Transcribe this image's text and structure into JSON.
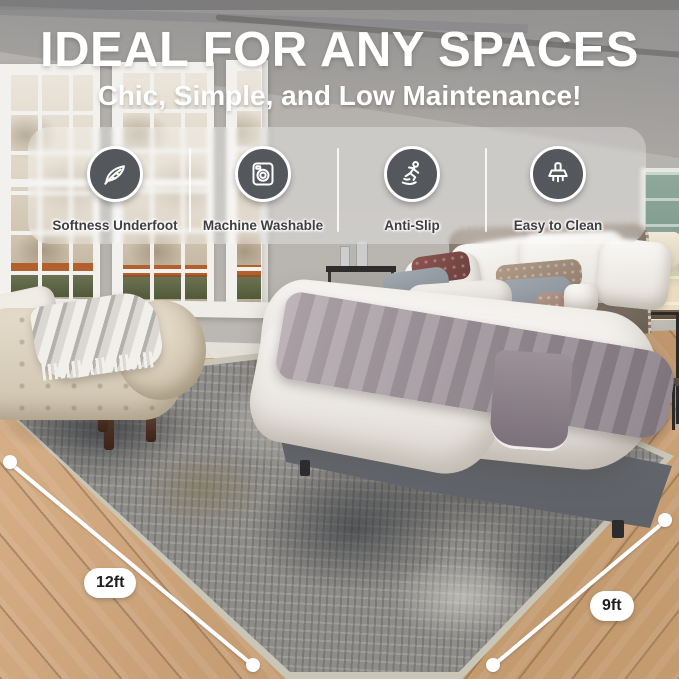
{
  "title": "IDEAL FOR ANY SPACES",
  "subtitle": "Chic, Simple, and Low Maintenance!",
  "features": [
    {
      "icon": "feather-icon",
      "label": "Softness Underfoot"
    },
    {
      "icon": "washing-machine-icon",
      "label": "Machine Washable"
    },
    {
      "icon": "slip-person-icon",
      "label": "Anti-Slip"
    },
    {
      "icon": "cleaning-brush-icon",
      "label": "Easy to Clean"
    }
  ],
  "measurements": {
    "left": {
      "label": "12ft"
    },
    "right": {
      "label": "9ft"
    }
  },
  "colors": {
    "title_text": "#ffffff",
    "feature_circle": "#54575b",
    "feature_label": "#3f3f41",
    "pill_background": "#ffffff",
    "pill_text": "#1f1f1f",
    "rug_base": "#8f8d89",
    "rug_dark": "#34383e",
    "rug_tan": "#8a7a52",
    "wood_floor": "#c89f75"
  }
}
